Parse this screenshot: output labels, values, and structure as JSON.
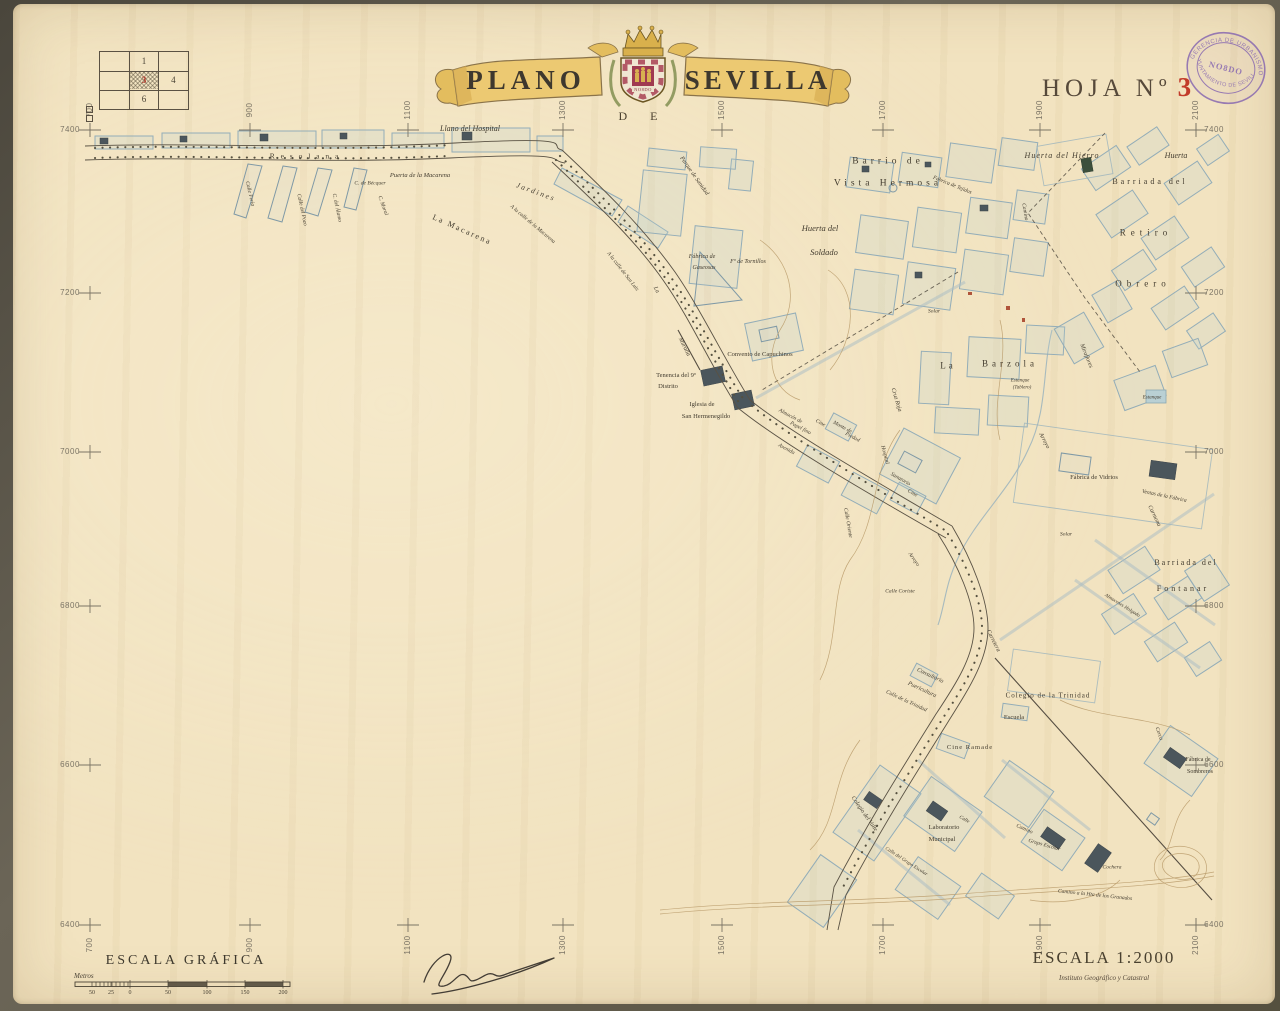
{
  "header": {
    "title_left": "PLANO",
    "title_right": "SEVILLA",
    "title_de": "D  E",
    "shield_motto": "NO8DO",
    "sheet_label": "HOJA Nº",
    "sheet_number": "3",
    "stamp": {
      "top_text": "GERENCIA DE URBANISMO",
      "bottom_text": "AYUNTAMIENTO DE SEVILLA",
      "center_text": "NO8DO"
    },
    "index_grid": {
      "cells": [
        {
          "row": 0,
          "col": 1,
          "label": "1",
          "highlight": false
        },
        {
          "row": 1,
          "col": 1,
          "label": "3",
          "highlight": true
        },
        {
          "row": 1,
          "col": 2,
          "label": "4",
          "highlight": false
        },
        {
          "row": 2,
          "col": 1,
          "label": "6",
          "highlight": false
        }
      ]
    }
  },
  "grid": {
    "top": [
      "700",
      "900",
      "1100",
      "1300",
      "1500",
      "1700",
      "1900",
      "2100"
    ],
    "bottom": [
      "700",
      "900",
      "1100",
      "1300",
      "1500",
      "1700",
      "1900",
      "2100"
    ],
    "left": [
      "7400",
      "7200",
      "7000",
      "6800",
      "6600",
      "6400"
    ],
    "right": [
      "7400",
      "7200",
      "7000",
      "6800",
      "6600",
      "6400"
    ]
  },
  "footer": {
    "scale_title": "ESCALA GRÁFICA",
    "metros_label": "Metros",
    "scale_numbers": [
      "50",
      "25",
      "0",
      "50",
      "100",
      "150",
      "200"
    ],
    "scale_text": "ESCALA 1:2000",
    "institute": "Instituto Geográfico y Catastral"
  },
  "map_labels": [
    {
      "t": "Llano del Hospital",
      "x": 470,
      "y": 129,
      "s": 8,
      "i": 1
    },
    {
      "t": "R e s o l a n a",
      "x": 305,
      "y": 156,
      "s": 7.5,
      "sp": 2
    },
    {
      "t": "Puerta de la Macarena",
      "x": 420,
      "y": 176,
      "s": 6.5,
      "i": 1
    },
    {
      "t": "Jardines",
      "x": 536,
      "y": 192,
      "s": 7.5,
      "r": 20,
      "sp": 2,
      "i": 1
    },
    {
      "t": "La Macarena",
      "x": 462,
      "y": 230,
      "s": 8,
      "r": 24,
      "sp": 2
    },
    {
      "t": "A la calle de la Macarena",
      "x": 532,
      "y": 225,
      "s": 5.5,
      "r": 40,
      "i": 1
    },
    {
      "t": "Calle Feria",
      "x": 249,
      "y": 194,
      "s": 5.5,
      "r": 77,
      "i": 1
    },
    {
      "t": "Calle del Pozo",
      "x": 301,
      "y": 210,
      "s": 5.5,
      "r": 78,
      "i": 1
    },
    {
      "t": "C. del Álamo",
      "x": 336,
      "y": 208,
      "s": 5.5,
      "r": 78,
      "i": 1
    },
    {
      "t": "C. de Bécquer",
      "x": 370,
      "y": 184,
      "s": 5.5,
      "i": 1
    },
    {
      "t": "C. Moral",
      "x": 382,
      "y": 206,
      "s": 5.5,
      "r": 70,
      "i": 1
    },
    {
      "t": "A la calle de San Luis",
      "x": 622,
      "y": 272,
      "s": 5.5,
      "r": 52,
      "i": 1
    },
    {
      "t": "Parque de Sanidad",
      "x": 694,
      "y": 176,
      "s": 6,
      "r": 55,
      "i": 1
    },
    {
      "t": "Barrio de",
      "x": 888,
      "y": 162,
      "s": 9.5,
      "sp": 4
    },
    {
      "t": "Vista Hermosa",
      "x": 888,
      "y": 184,
      "s": 9.5,
      "sp": 4
    },
    {
      "t": "Fábrica de Tejidos",
      "x": 952,
      "y": 186,
      "s": 5.5,
      "r": 22,
      "i": 1
    },
    {
      "t": "Huerta del Hierro",
      "x": 1062,
      "y": 156,
      "s": 8,
      "i": 1,
      "sp": 1
    },
    {
      "t": "Huerta",
      "x": 1176,
      "y": 156,
      "s": 8,
      "i": 1
    },
    {
      "t": "Barriada del",
      "x": 1150,
      "y": 182,
      "s": 8,
      "sp": 3
    },
    {
      "t": "Retiro",
      "x": 1146,
      "y": 233,
      "s": 9,
      "sp": 5
    },
    {
      "t": "Obrero",
      "x": 1143,
      "y": 284,
      "s": 9,
      "sp": 5
    },
    {
      "t": "Camino",
      "x": 1024,
      "y": 212,
      "s": 5.5,
      "r": 80,
      "i": 1
    },
    {
      "t": "Huerta del",
      "x": 820,
      "y": 228,
      "s": 8.5,
      "i": 1
    },
    {
      "t": "Soldado",
      "x": 824,
      "y": 252,
      "s": 8.5,
      "i": 1
    },
    {
      "t": "Fábrica de",
      "x": 702,
      "y": 257,
      "s": 6,
      "i": 1
    },
    {
      "t": "Gaseosas",
      "x": 704,
      "y": 268,
      "s": 6,
      "i": 1
    },
    {
      "t": "Fº de Tornillos",
      "x": 748,
      "y": 262,
      "s": 6,
      "i": 1
    },
    {
      "t": "La",
      "x": 656,
      "y": 290,
      "s": 6,
      "r": 62,
      "i": 1
    },
    {
      "t": "Muralla",
      "x": 684,
      "y": 347,
      "s": 6,
      "r": 64,
      "i": 1
    },
    {
      "t": "Convento de Capuchinos",
      "x": 760,
      "y": 355,
      "s": 6.5
    },
    {
      "t": "Tenencia del 9º",
      "x": 676,
      "y": 376,
      "s": 6.5
    },
    {
      "t": "Distrito",
      "x": 668,
      "y": 387,
      "s": 6.5
    },
    {
      "t": "Iglesia de",
      "x": 702,
      "y": 405,
      "s": 6.5
    },
    {
      "t": "San Hermenegildo",
      "x": 706,
      "y": 417,
      "s": 6.5
    },
    {
      "t": "Almacén de",
      "x": 790,
      "y": 417,
      "s": 5.5,
      "r": 28,
      "i": 1
    },
    {
      "t": "Papel fino",
      "x": 800,
      "y": 429,
      "s": 5.5,
      "r": 28,
      "i": 1
    },
    {
      "t": "Cine",
      "x": 820,
      "y": 424,
      "s": 5.5,
      "r": 28,
      "i": 1
    },
    {
      "t": "Monte de",
      "x": 842,
      "y": 428,
      "s": 5.5,
      "r": 28,
      "i": 1
    },
    {
      "t": "Piedad",
      "x": 852,
      "y": 438,
      "s": 5.5,
      "r": 28,
      "i": 1
    },
    {
      "t": "Avenida",
      "x": 786,
      "y": 450,
      "s": 5.5,
      "r": 28,
      "i": 1
    },
    {
      "t": "Hospital",
      "x": 884,
      "y": 455,
      "s": 5.5,
      "r": 75,
      "i": 1
    },
    {
      "t": "Sanatorio",
      "x": 900,
      "y": 480,
      "s": 5.5,
      "r": 30,
      "i": 1
    },
    {
      "t": "Cine",
      "x": 912,
      "y": 494,
      "s": 5.5,
      "r": 30,
      "i": 1
    },
    {
      "t": "Cruz Roja",
      "x": 896,
      "y": 400,
      "s": 6,
      "r": 73,
      "i": 1
    },
    {
      "t": "La",
      "x": 948,
      "y": 366,
      "s": 9,
      "sp": 3
    },
    {
      "t": "Barzola",
      "x": 1010,
      "y": 364,
      "s": 9,
      "sp": 4
    },
    {
      "t": "Estanque",
      "x": 1020,
      "y": 381,
      "s": 5,
      "i": 1
    },
    {
      "t": "(Tablero)",
      "x": 1022,
      "y": 388,
      "s": 5,
      "i": 1
    },
    {
      "t": "Solar",
      "x": 934,
      "y": 312,
      "s": 5.5,
      "i": 1
    },
    {
      "t": "Solar",
      "x": 1066,
      "y": 535,
      "s": 5.5,
      "i": 1
    },
    {
      "t": "Miraflores",
      "x": 1086,
      "y": 356,
      "s": 6,
      "r": 68,
      "i": 1
    },
    {
      "t": "Arroyo",
      "x": 1044,
      "y": 441,
      "s": 6,
      "r": 62,
      "i": 1
    },
    {
      "t": "Estanque",
      "x": 1152,
      "y": 398,
      "s": 5,
      "i": 1
    },
    {
      "t": "Fábrica de Vidrios",
      "x": 1094,
      "y": 478,
      "s": 6.5
    },
    {
      "t": "Ventas de la Fábrica",
      "x": 1164,
      "y": 497,
      "s": 5.5,
      "r": 12,
      "i": 1
    },
    {
      "t": "Carmona",
      "x": 1154,
      "y": 516,
      "s": 6,
      "r": 64,
      "i": 1
    },
    {
      "t": "Barriada del",
      "x": 1186,
      "y": 563,
      "s": 8,
      "sp": 2
    },
    {
      "t": "Fontanar",
      "x": 1183,
      "y": 589,
      "s": 8,
      "sp": 3
    },
    {
      "t": "Almacenes Holgado",
      "x": 1122,
      "y": 606,
      "s": 5,
      "r": 32,
      "i": 1
    },
    {
      "t": "Calle Oriente",
      "x": 847,
      "y": 523,
      "s": 5.5,
      "r": 80,
      "i": 1
    },
    {
      "t": "Arroyo",
      "x": 913,
      "y": 560,
      "s": 5.5,
      "r": 55,
      "i": 1
    },
    {
      "t": "Calle Coriste",
      "x": 900,
      "y": 592,
      "s": 5.5,
      "i": 1
    },
    {
      "t": "Carretera",
      "x": 993,
      "y": 641,
      "s": 6,
      "r": 63,
      "i": 1
    },
    {
      "t": "Consultorio",
      "x": 930,
      "y": 676,
      "s": 6,
      "r": 25,
      "i": 1
    },
    {
      "t": "Puericultura",
      "x": 922,
      "y": 690,
      "s": 6,
      "r": 25,
      "i": 1
    },
    {
      "t": "Calle de la Trinidad",
      "x": 906,
      "y": 702,
      "s": 5.5,
      "r": 25,
      "i": 1
    },
    {
      "t": "Colegio de la Trinidad",
      "x": 1048,
      "y": 696,
      "s": 7,
      "sp": 1
    },
    {
      "t": "Escuela",
      "x": 1014,
      "y": 718,
      "s": 6.5
    },
    {
      "t": "Cine Ramade",
      "x": 970,
      "y": 748,
      "s": 6.5,
      "sp": 1
    },
    {
      "t": "Cerca",
      "x": 1158,
      "y": 734,
      "s": 5.5,
      "r": 70,
      "i": 1
    },
    {
      "t": "Fábrica de",
      "x": 1198,
      "y": 760,
      "s": 6
    },
    {
      "t": "Sombreros",
      "x": 1200,
      "y": 772,
      "s": 6
    },
    {
      "t": "Colegio del Valle",
      "x": 864,
      "y": 814,
      "s": 6,
      "r": 55,
      "i": 1
    },
    {
      "t": "Laboratorio",
      "x": 944,
      "y": 828,
      "s": 6.5
    },
    {
      "t": "Municipal",
      "x": 942,
      "y": 840,
      "s": 6.5
    },
    {
      "t": "Calle",
      "x": 964,
      "y": 820,
      "s": 5,
      "r": 30,
      "i": 1
    },
    {
      "t": "Calle del Grupo Escolar",
      "x": 906,
      "y": 862,
      "s": 5,
      "r": 33,
      "i": 1
    },
    {
      "t": "Camino",
      "x": 1024,
      "y": 830,
      "s": 5.5,
      "r": 24,
      "i": 1
    },
    {
      "t": "Grupo Escolar",
      "x": 1044,
      "y": 846,
      "s": 5.5,
      "r": 16,
      "i": 1
    },
    {
      "t": "Cochera",
      "x": 1112,
      "y": 868,
      "s": 5.5,
      "i": 1
    },
    {
      "t": "Camino a la Hta de los Granados",
      "x": 1095,
      "y": 896,
      "s": 5.5,
      "r": 6,
      "i": 1
    }
  ]
}
